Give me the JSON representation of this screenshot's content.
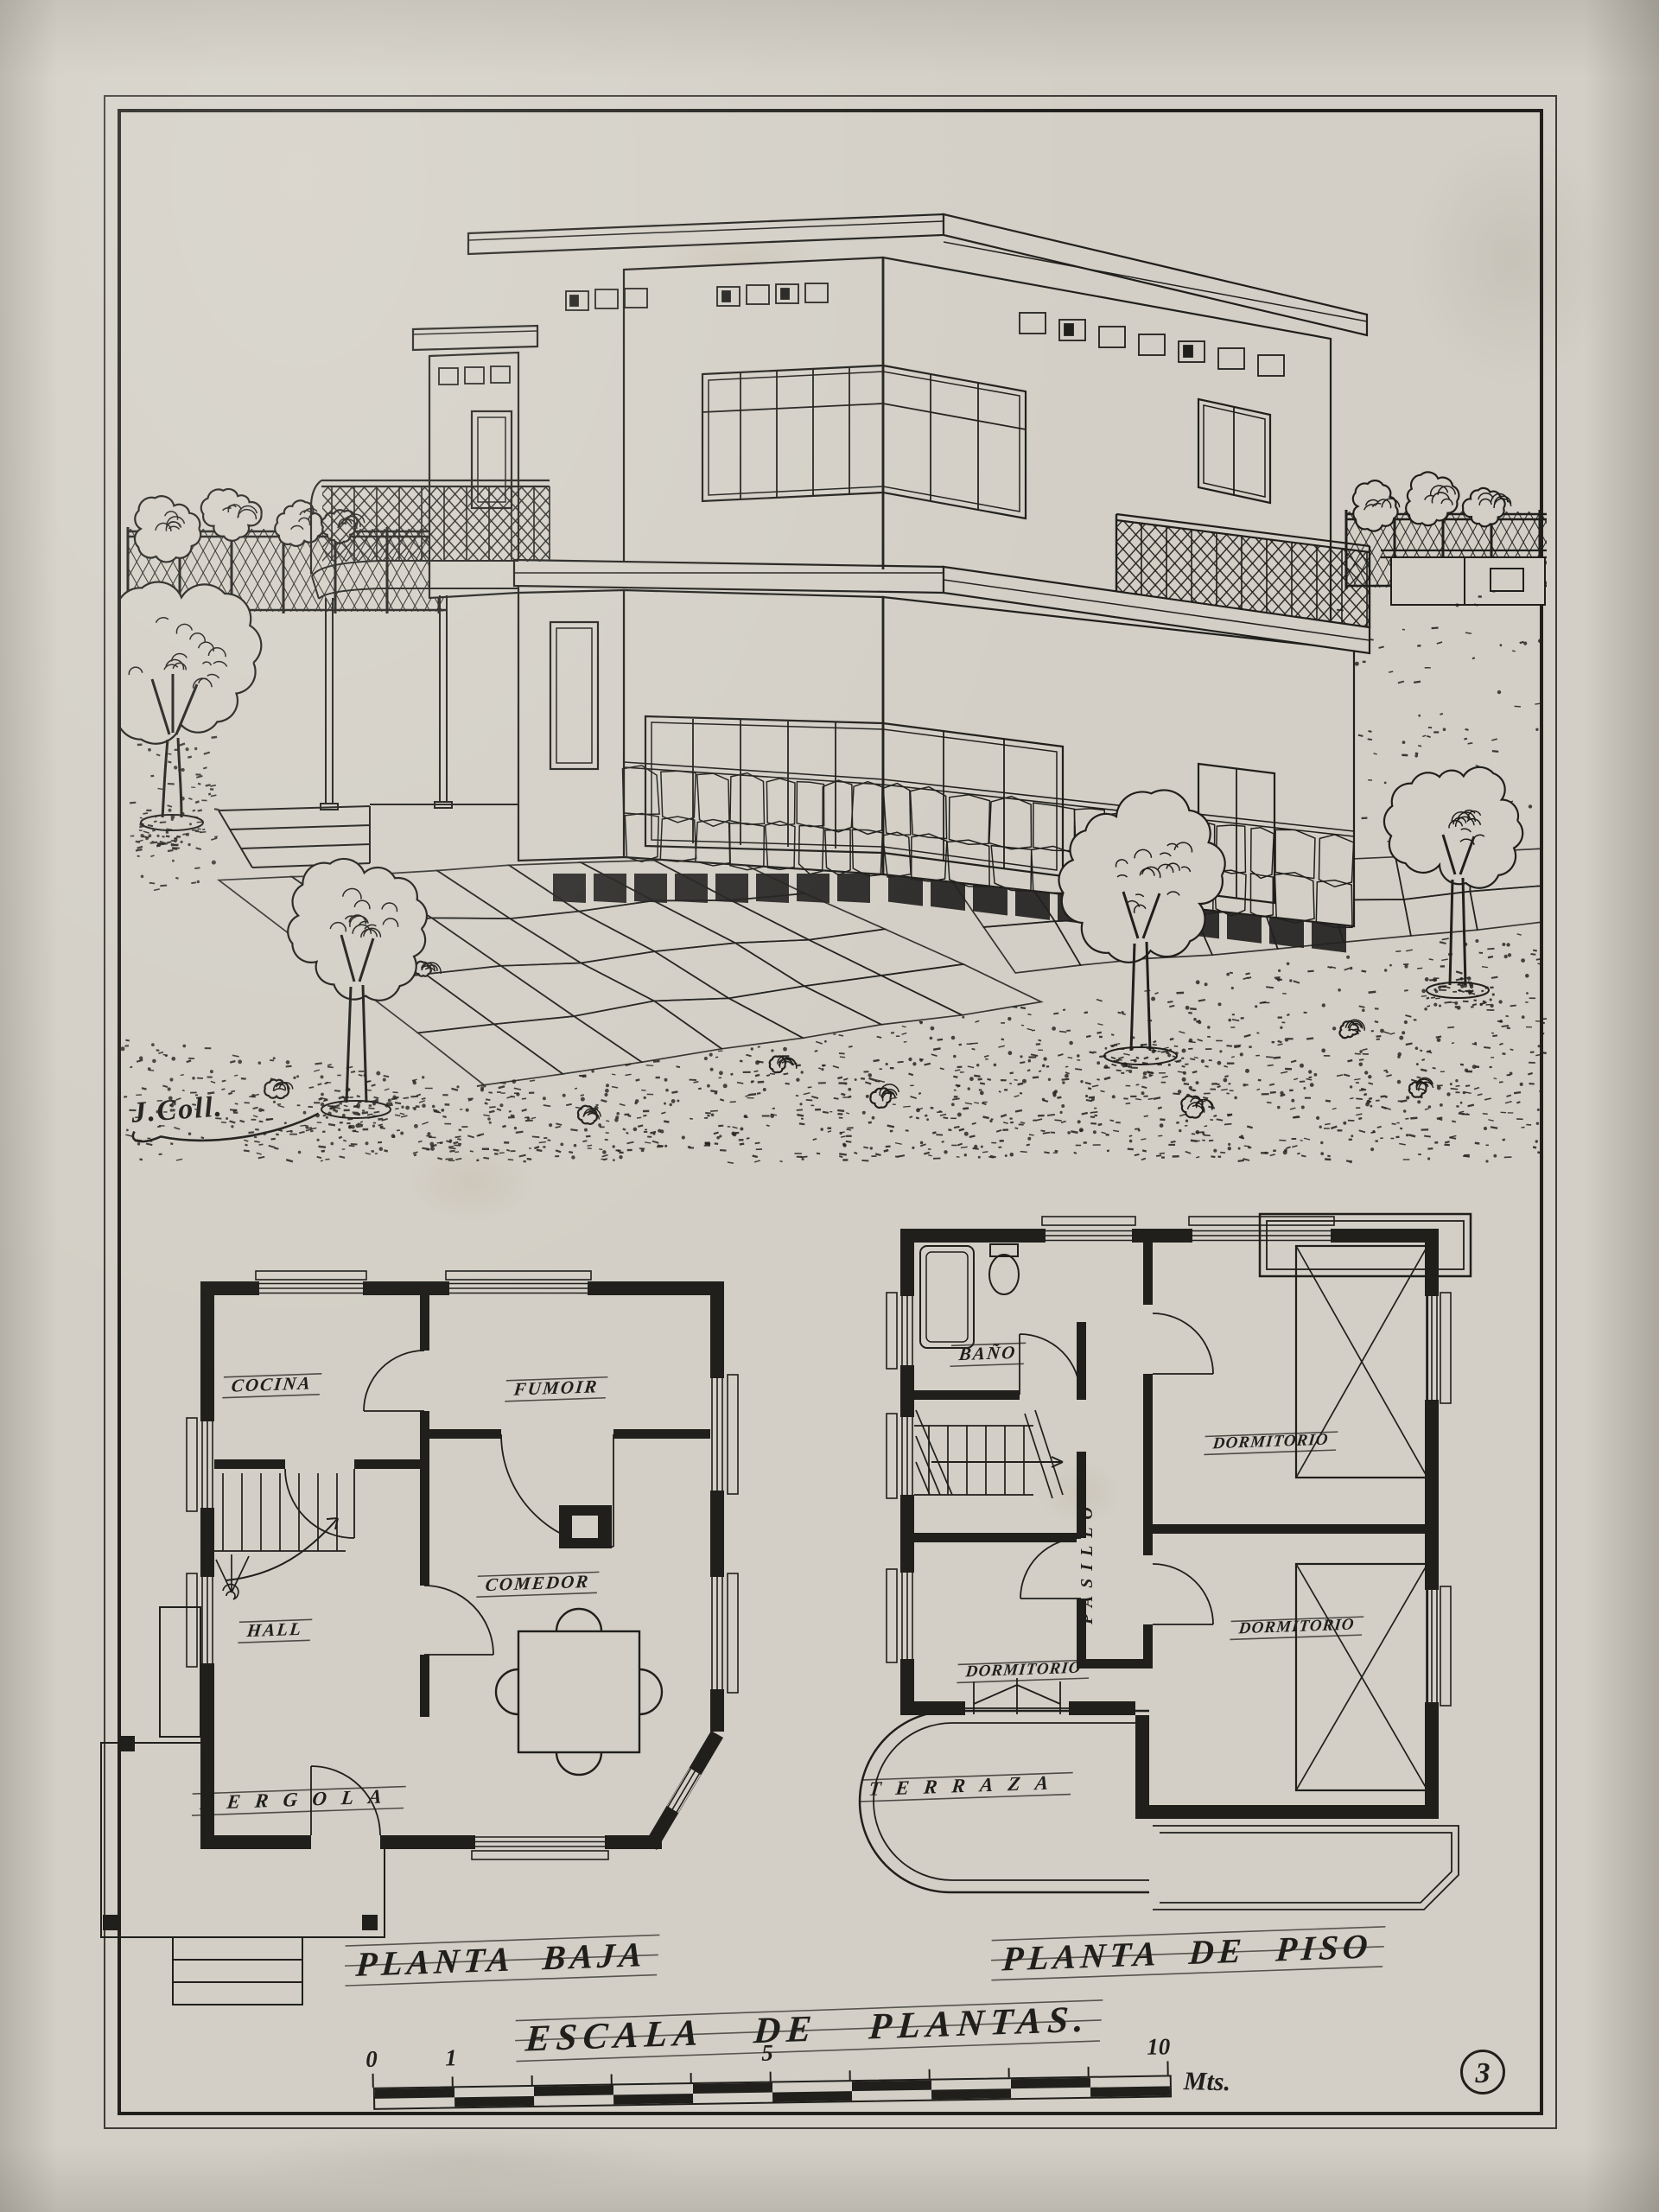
{
  "palette": {
    "paper": "#d3cfc6",
    "ink": "#201f1c"
  },
  "plate": {
    "number": "3",
    "signature": "J.Coll.",
    "scale_title": "ESCALA  DE  PLANTAS.",
    "scale_unit": "Mts.",
    "scale_ticks": [
      "0",
      "1",
      "5",
      "10"
    ]
  },
  "ground_floor": {
    "caption": "PLANTA BAJA",
    "rooms": {
      "cocina": "COCINA",
      "fumoir": "FUMOIR",
      "comedor": "COMEDOR",
      "hall": "HALL",
      "pergola": "PERGOLA"
    }
  },
  "upper_floor": {
    "caption": "PLANTA DE PISO",
    "rooms": {
      "bano": "BAÑO",
      "pasillo": "PASILLO",
      "dormitorio1": "DORMITORIO",
      "dormitorio2": "DORMITORIO",
      "dormitorio3": "DORMITORIO",
      "terraza": "TERRAZA"
    }
  }
}
